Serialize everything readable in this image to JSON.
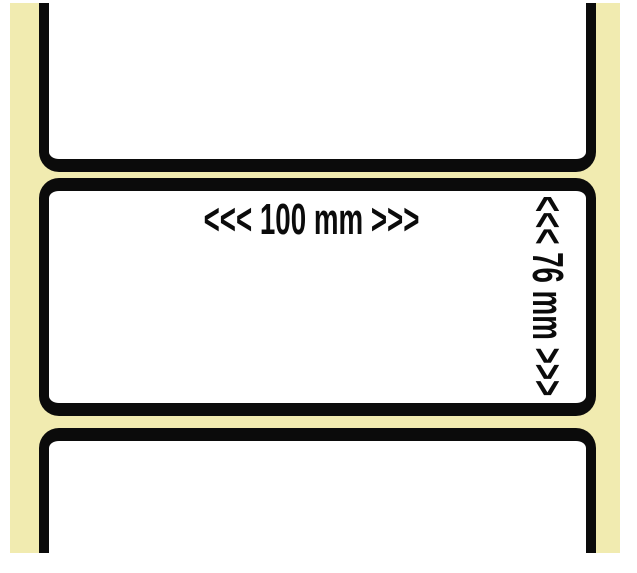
{
  "photo": {
    "liner_color": "#f1ebb0",
    "label_fill_color": "#ffffff",
    "label_outline_color": "#0b0b0b",
    "text_color": "#0b0b0b"
  },
  "dimensions": {
    "width_text": "<<< 100 mm >>>",
    "height_text": "<<< 76 mm >>>"
  }
}
